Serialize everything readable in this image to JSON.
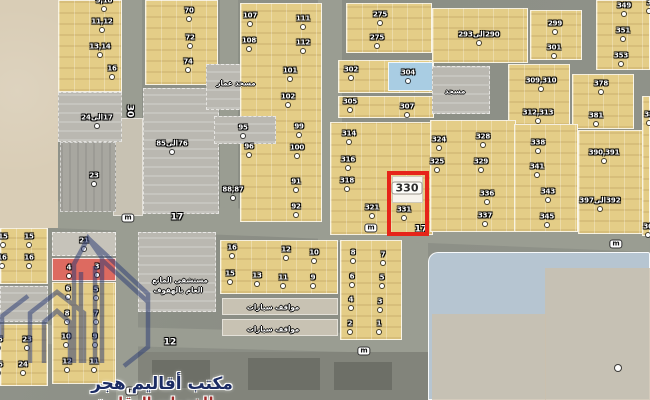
{
  "palette": {
    "sand": "#d9cdb6",
    "y": "#e4cd87",
    "g": "#bab8b1",
    "g2": "#a8a7a0",
    "light": "#c8c2b3",
    "lightgray": "#c6c3ba",
    "red": "#dd6a60",
    "blue": "#a9cde3",
    "bluefield": "#b6c5d1",
    "sandblue": "#cbbfac",
    "dark": "#82847b",
    "dark2": "#6d6f67",
    "white": "#f7f4ed",
    "road": "#9a9d92"
  },
  "highlight": {
    "label": "330",
    "x": 387,
    "y": 171,
    "w": 42,
    "h": 65,
    "color": "#e62419"
  },
  "watermark": {
    "title": "مكتب أقاليم هجر",
    "subtitle": "للخدمات العقارية",
    "title_color": "#1c2c64",
    "subtitle_color": "#a22a28",
    "logo_color": "#2c3c74"
  },
  "roads": [
    {
      "x": 120,
      "y": 0,
      "w": 22,
      "h": 236
    },
    {
      "x": 220,
      "y": 0,
      "w": 18,
      "h": 215
    },
    {
      "x": 318,
      "y": 0,
      "w": 24,
      "h": 242
    },
    {
      "x": 116,
      "y": 230,
      "w": 22,
      "h": 170
    },
    {
      "x": 402,
      "y": 238,
      "w": 26,
      "h": 162
    },
    {
      "x": -5,
      "y": 212,
      "w": 665,
      "h": 27,
      "rot": 2.3
    },
    {
      "x": 40,
      "y": 330,
      "w": 392,
      "h": 19,
      "rot": 1.5
    }
  ],
  "blocks": [
    [
      0,
      0,
      58,
      228,
      "sand"
    ],
    [
      113,
      118,
      30,
      98,
      "light"
    ],
    [
      58,
      0,
      64,
      92,
      "y"
    ],
    [
      58,
      92,
      64,
      50,
      "g"
    ],
    [
      60,
      142,
      56,
      70,
      "g2"
    ],
    [
      145,
      0,
      73,
      85,
      "y"
    ],
    [
      143,
      88,
      76,
      126,
      "g"
    ],
    [
      206,
      64,
      58,
      46,
      "g"
    ],
    [
      240,
      3,
      82,
      219,
      "y"
    ],
    [
      214,
      116,
      62,
      28,
      "g"
    ],
    [
      346,
      3,
      86,
      50,
      "y"
    ],
    [
      338,
      60,
      96,
      33,
      "y"
    ],
    [
      388,
      62,
      45,
      29,
      "blue"
    ],
    [
      338,
      96,
      96,
      22,
      "y"
    ],
    [
      330,
      122,
      103,
      113,
      "y"
    ],
    [
      432,
      8,
      96,
      55,
      "y"
    ],
    [
      530,
      10,
      52,
      50,
      "y"
    ],
    [
      432,
      66,
      58,
      48,
      "g"
    ],
    [
      508,
      64,
      62,
      62,
      "y"
    ],
    [
      596,
      0,
      54,
      70,
      "y"
    ],
    [
      572,
      74,
      62,
      55,
      "y"
    ],
    [
      430,
      120,
      86,
      112,
      "y"
    ],
    [
      514,
      124,
      64,
      108,
      "y"
    ],
    [
      578,
      130,
      72,
      104,
      "y"
    ],
    [
      642,
      96,
      8,
      140,
      "y"
    ],
    [
      0,
      228,
      48,
      56,
      "y"
    ],
    [
      0,
      286,
      48,
      36,
      "g"
    ],
    [
      0,
      324,
      48,
      62,
      "y"
    ],
    [
      52,
      232,
      64,
      24,
      "lightgray"
    ],
    [
      52,
      258,
      64,
      23,
      "red"
    ],
    [
      52,
      282,
      64,
      102,
      "y"
    ],
    [
      138,
      232,
      78,
      80,
      "g"
    ],
    [
      220,
      240,
      118,
      54,
      "y"
    ],
    [
      222,
      298,
      116,
      17,
      "light"
    ],
    [
      222,
      319,
      116,
      17,
      "light"
    ],
    [
      340,
      240,
      62,
      100,
      "y"
    ],
    [
      138,
      352,
      292,
      48,
      "dark"
    ],
    [
      152,
      360,
      58,
      28,
      "dark2"
    ],
    [
      248,
      358,
      72,
      32,
      "dark2"
    ],
    [
      334,
      362,
      58,
      28,
      "dark2"
    ],
    [
      428,
      252,
      222,
      148,
      "bluefield"
    ],
    [
      545,
      268,
      105,
      132,
      "sandblue"
    ],
    [
      432,
      314,
      114,
      86,
      "sandblue"
    ],
    [
      392,
      176,
      31,
      27,
      "white"
    ]
  ],
  "labels": [
    {
      "t": "9,10",
      "x": 104,
      "y": 1,
      "k": "p"
    },
    {
      "t": "11,12",
      "x": 102,
      "y": 22,
      "k": "p"
    },
    {
      "t": "13,14",
      "x": 100,
      "y": 47,
      "k": "p"
    },
    {
      "t": "16",
      "x": 112,
      "y": 69,
      "k": "p"
    },
    {
      "t": "17الى24",
      "x": 97,
      "y": 118,
      "k": "p",
      "rtl": 1
    },
    {
      "t": "70",
      "x": 189,
      "y": 11,
      "k": "p"
    },
    {
      "t": "72",
      "x": 190,
      "y": 38,
      "k": "p"
    },
    {
      "t": "74",
      "x": 188,
      "y": 62,
      "k": "p"
    },
    {
      "t": "76الى85",
      "x": 172,
      "y": 144,
      "k": "p",
      "rtl": 1
    },
    {
      "t": "23",
      "x": 94,
      "y": 176,
      "k": "p"
    },
    {
      "t": "107",
      "x": 250,
      "y": 16,
      "k": "p"
    },
    {
      "t": "108",
      "x": 249,
      "y": 41,
      "k": "p"
    },
    {
      "t": "111",
      "x": 303,
      "y": 19,
      "k": "p"
    },
    {
      "t": "112",
      "x": 303,
      "y": 43,
      "k": "p"
    },
    {
      "t": "101",
      "x": 290,
      "y": 71,
      "k": "p"
    },
    {
      "t": "102",
      "x": 288,
      "y": 97,
      "k": "p"
    },
    {
      "t": "95",
      "x": 243,
      "y": 128,
      "k": "p"
    },
    {
      "t": "96",
      "x": 249,
      "y": 147,
      "k": "p"
    },
    {
      "t": "99",
      "x": 299,
      "y": 127,
      "k": "p"
    },
    {
      "t": "100",
      "x": 297,
      "y": 148,
      "k": "p"
    },
    {
      "t": "88,87",
      "x": 233,
      "y": 190,
      "k": "p"
    },
    {
      "t": "91",
      "x": 296,
      "y": 182,
      "k": "p"
    },
    {
      "t": "92",
      "x": 296,
      "y": 207,
      "k": "p"
    },
    {
      "t": "275",
      "x": 380,
      "y": 15,
      "k": "p"
    },
    {
      "t": "275",
      "x": 377,
      "y": 38,
      "k": "p"
    },
    {
      "t": "302",
      "x": 351,
      "y": 70,
      "k": "p"
    },
    {
      "t": "304",
      "x": 408,
      "y": 73,
      "k": "p"
    },
    {
      "t": "305",
      "x": 350,
      "y": 102,
      "k": "p"
    },
    {
      "t": "307",
      "x": 407,
      "y": 107,
      "k": "p"
    },
    {
      "t": "314",
      "x": 349,
      "y": 134,
      "k": "p"
    },
    {
      "t": "316",
      "x": 348,
      "y": 160,
      "k": "p"
    },
    {
      "t": "318",
      "x": 347,
      "y": 181,
      "k": "p"
    },
    {
      "t": "321",
      "x": 372,
      "y": 208,
      "k": "p"
    },
    {
      "t": "290الى293",
      "x": 479,
      "y": 35,
      "k": "p",
      "rtl": 1
    },
    {
      "t": "299",
      "x": 555,
      "y": 24,
      "k": "p"
    },
    {
      "t": "301",
      "x": 554,
      "y": 48,
      "k": "p"
    },
    {
      "t": "309,310",
      "x": 541,
      "y": 81,
      "k": "p"
    },
    {
      "t": "312,313",
      "x": 538,
      "y": 113,
      "k": "p"
    },
    {
      "t": "349",
      "x": 624,
      "y": 6,
      "k": "p"
    },
    {
      "t": "351",
      "x": 623,
      "y": 31,
      "k": "p"
    },
    {
      "t": "353",
      "x": 621,
      "y": 56,
      "k": "p"
    },
    {
      "t": "378",
      "x": 601,
      "y": 84,
      "k": "p"
    },
    {
      "t": "381",
      "x": 596,
      "y": 116,
      "k": "p"
    },
    {
      "t": "324",
      "x": 439,
      "y": 140,
      "k": "p"
    },
    {
      "t": "325",
      "x": 437,
      "y": 162,
      "k": "p"
    },
    {
      "t": "328",
      "x": 483,
      "y": 137,
      "k": "p"
    },
    {
      "t": "329",
      "x": 481,
      "y": 162,
      "k": "p"
    },
    {
      "t": "336",
      "x": 487,
      "y": 194,
      "k": "p"
    },
    {
      "t": "337",
      "x": 485,
      "y": 216,
      "k": "p"
    },
    {
      "t": "338",
      "x": 538,
      "y": 143,
      "k": "p"
    },
    {
      "t": "341",
      "x": 537,
      "y": 167,
      "k": "p"
    },
    {
      "t": "343",
      "x": 548,
      "y": 192,
      "k": "p"
    },
    {
      "t": "345",
      "x": 547,
      "y": 217,
      "k": "p"
    },
    {
      "t": "390,391",
      "x": 604,
      "y": 153,
      "k": "p"
    },
    {
      "t": "392الى397",
      "x": 600,
      "y": 201,
      "k": "p",
      "rtl": 1
    },
    {
      "t": "331",
      "x": 404,
      "y": 210,
      "k": "p"
    },
    {
      "t": "330",
      "x": 407,
      "y": 188,
      "k": "hi"
    },
    {
      "t": "3",
      "x": 649,
      "y": 3,
      "k": "p"
    },
    {
      "t": "38",
      "x": 649,
      "y": 115,
      "k": "p"
    },
    {
      "t": "36",
      "x": 648,
      "y": 227,
      "k": "p"
    },
    {
      "t": "15",
      "x": 3,
      "y": 237,
      "k": "p"
    },
    {
      "t": "15",
      "x": 29,
      "y": 237,
      "k": "p"
    },
    {
      "t": "16",
      "x": 2,
      "y": 258,
      "k": "p"
    },
    {
      "t": "16",
      "x": 29,
      "y": 258,
      "k": "p"
    },
    {
      "t": "23",
      "x": 27,
      "y": 340,
      "k": "p"
    },
    {
      "t": "24",
      "x": 23,
      "y": 365,
      "k": "p"
    },
    {
      "t": "25",
      "x": -2,
      "y": 340,
      "k": "p"
    },
    {
      "t": "26",
      "x": -2,
      "y": 365,
      "k": "p"
    },
    {
      "t": "21",
      "x": 84,
      "y": 241,
      "k": "p"
    },
    {
      "t": "4",
      "x": 69,
      "y": 268,
      "k": "p"
    },
    {
      "t": "3",
      "x": 97,
      "y": 267,
      "k": "p"
    },
    {
      "t": "6",
      "x": 68,
      "y": 289,
      "k": "p"
    },
    {
      "t": "5",
      "x": 96,
      "y": 290,
      "k": "p"
    },
    {
      "t": "8",
      "x": 67,
      "y": 314,
      "k": "p"
    },
    {
      "t": "7",
      "x": 96,
      "y": 314,
      "k": "p"
    },
    {
      "t": "10",
      "x": 66,
      "y": 337,
      "k": "p"
    },
    {
      "t": "9",
      "x": 95,
      "y": 337,
      "k": "p"
    },
    {
      "t": "12",
      "x": 67,
      "y": 362,
      "k": "p"
    },
    {
      "t": "11",
      "x": 94,
      "y": 362,
      "k": "p"
    },
    {
      "t": "16",
      "x": 232,
      "y": 248,
      "k": "p"
    },
    {
      "t": "12",
      "x": 286,
      "y": 250,
      "k": "p"
    },
    {
      "t": "10",
      "x": 314,
      "y": 253,
      "k": "p"
    },
    {
      "t": "15",
      "x": 230,
      "y": 274,
      "k": "p"
    },
    {
      "t": "13",
      "x": 257,
      "y": 276,
      "k": "p"
    },
    {
      "t": "11",
      "x": 283,
      "y": 278,
      "k": "p"
    },
    {
      "t": "9",
      "x": 313,
      "y": 278,
      "k": "p"
    },
    {
      "t": "8",
      "x": 353,
      "y": 253,
      "k": "p"
    },
    {
      "t": "7",
      "x": 383,
      "y": 255,
      "k": "p"
    },
    {
      "t": "6",
      "x": 352,
      "y": 277,
      "k": "p"
    },
    {
      "t": "5",
      "x": 382,
      "y": 278,
      "k": "p"
    },
    {
      "t": "4",
      "x": 351,
      "y": 300,
      "k": "p"
    },
    {
      "t": "3",
      "x": 380,
      "y": 302,
      "k": "p"
    },
    {
      "t": "2",
      "x": 350,
      "y": 324,
      "k": "p"
    },
    {
      "t": "1",
      "x": 379,
      "y": 324,
      "k": "p"
    },
    {
      "t": "30",
      "x": 129,
      "y": 111,
      "k": "s",
      "rot": 90
    },
    {
      "t": "m",
      "x": 128,
      "y": 218,
      "k": "m"
    },
    {
      "t": "17",
      "x": 177,
      "y": 218,
      "k": "s"
    },
    {
      "t": "m",
      "x": 371,
      "y": 228,
      "k": "m"
    },
    {
      "t": "17",
      "x": 421,
      "y": 230,
      "k": "s"
    },
    {
      "t": "m",
      "x": 616,
      "y": 244,
      "k": "m"
    },
    {
      "t": "12",
      "x": 170,
      "y": 343,
      "k": "s"
    },
    {
      "t": "m",
      "x": 364,
      "y": 351,
      "k": "m"
    },
    {
      "t": "m",
      "x": 132,
      "y": 391,
      "k": "m"
    },
    {
      "t": "مسجد عمار",
      "x": 236,
      "y": 84,
      "k": "a",
      "rtl": 1
    },
    {
      "t": "مسجد",
      "x": 455,
      "y": 92,
      "k": "a",
      "rtl": 1
    },
    {
      "t": "مستشفى المانع",
      "x": 180,
      "y": 281,
      "k": "a",
      "rtl": 1
    },
    {
      "t": "العام بالهفوف",
      "x": 178,
      "y": 291,
      "k": "a",
      "rtl": 1
    },
    {
      "t": "مواقف سيارات",
      "x": 273,
      "y": 308,
      "k": "a",
      "rtl": 1
    },
    {
      "t": "مواقف سيارات",
      "x": 273,
      "y": 330,
      "k": "a",
      "rtl": 1
    }
  ],
  "dots": [
    {
      "x": 618,
      "y": 368,
      "big": 1
    }
  ]
}
